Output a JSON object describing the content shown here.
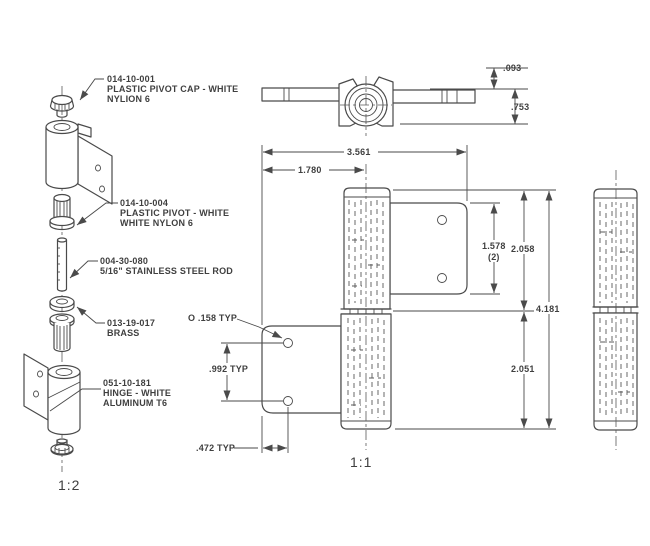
{
  "drawing": {
    "background": "#ffffff",
    "line_color": "#4a4a4a",
    "callouts": [
      {
        "lines": [
          "014-10-001",
          "PLASTIC PIVOT CAP - WHITE",
          "NYLION 6"
        ]
      },
      {
        "lines": [
          "014-10-004",
          "PLASTIC PIVOT - WHITE",
          "WHITE NYLON 6"
        ]
      },
      {
        "lines": [
          "004-30-080",
          "5/16\" STAINLESS STEEL ROD"
        ]
      },
      {
        "lines": [
          "013-19-017",
          "BRASS"
        ]
      },
      {
        "lines": [
          "051-10-181",
          "HINGE - WHITE",
          "ALUMINUM T6"
        ]
      }
    ],
    "dims": {
      "offset": ".093",
      "top_height": ".753",
      "overall_width": "3.561",
      "left_to_center": "1.780",
      "leaf_height": "1.578",
      "leaf_qty": "(2)",
      "upper_half": "2.058",
      "overall_height": "4.181",
      "lower_half": "2.051",
      "hole_dia": "O .158 TYP",
      "hole_spacing": ".992 TYP",
      "hole_edge": ".472 TYP"
    },
    "scales": {
      "exploded": "1:2",
      "front": "1:1"
    }
  }
}
